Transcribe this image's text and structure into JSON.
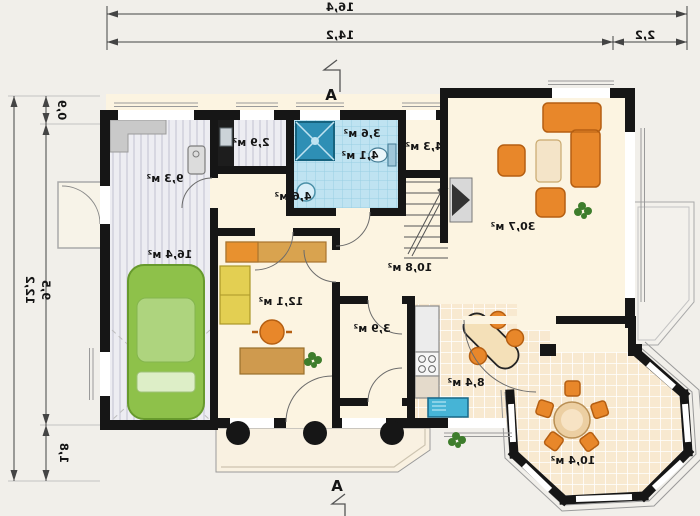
{
  "dimensions": {
    "top_total": "16,4",
    "top_seg_main": "14,2",
    "top_seg_side": "2,2",
    "left_total": "12,2",
    "left_seg_top": "0,9",
    "left_seg_mid": "9,5",
    "left_seg_bottom": "1,8"
  },
  "section_markers": {
    "top": "A",
    "bottom": "A"
  },
  "rooms": [
    {
      "id": "utility",
      "label": "9,3 м²"
    },
    {
      "id": "wc",
      "label": "2,9 м²"
    },
    {
      "id": "bath-a",
      "label": "3,6 м²"
    },
    {
      "id": "bath-b",
      "label": "4,1 м²"
    },
    {
      "id": "closet",
      "label": "4,3 м²"
    },
    {
      "id": "hallway",
      "label": "4,6 м²"
    },
    {
      "id": "living",
      "label": "30,7 м²"
    },
    {
      "id": "garage",
      "label": "16,4 м²"
    },
    {
      "id": "bedroom",
      "label": "12,1 м²"
    },
    {
      "id": "hall",
      "label": "10,8 м²"
    },
    {
      "id": "pantry",
      "label": "3,9 м²"
    },
    {
      "id": "kitchen",
      "label": "8,4 м²"
    },
    {
      "id": "dining",
      "label": "10,4 м²"
    }
  ],
  "colors": {
    "wall": "#161616",
    "floor_cream": "#fcf4e1",
    "floor_stripe": "#ededf2",
    "floor_tile_blue": "#bfe3f1",
    "floor_checker": "#f8e9d0",
    "furniture_orange": "#e8872a",
    "furniture_wood": "#d9a34f",
    "car_green": "#8ec14a",
    "plant_green": "#3e7d2c",
    "dim_line": "#444444",
    "sill_gray": "#9a9a9a"
  }
}
